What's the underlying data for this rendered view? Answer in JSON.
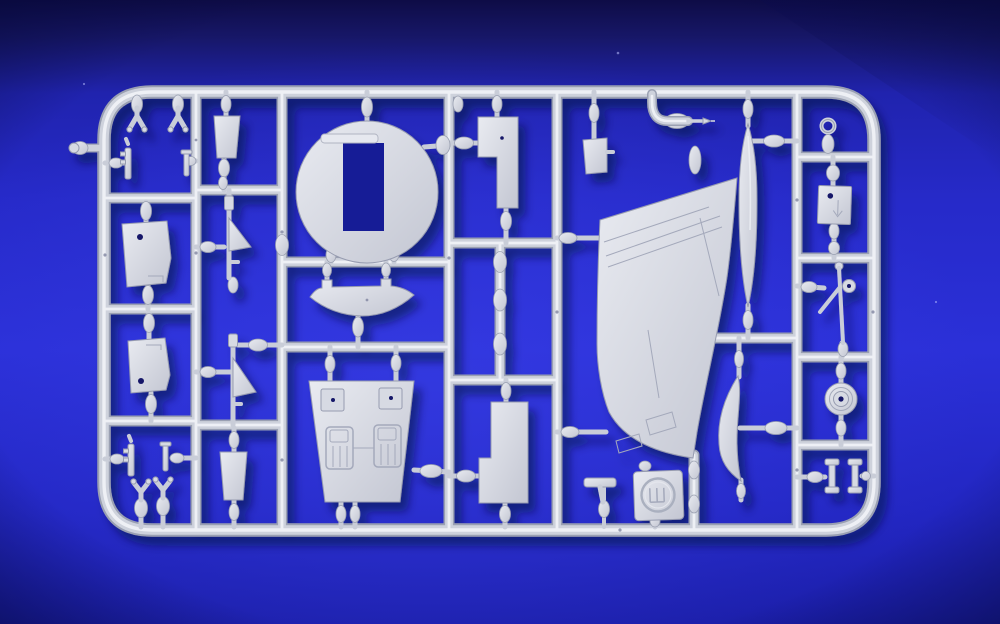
{
  "scene": {
    "type": "photograph",
    "description": "Photograph of an injection-moulded plastic model aircraft kit sprue (runner frame with parts) in light grey styrene, lying on a royal blue fabric background. No readable text appears in the image; one small square part carries a circular maker's emblem.",
    "text_visible": false
  },
  "colors": {
    "bg-deep": "#0e0c46",
    "bg-mid": "#262ac9",
    "bg-bright": "#2e33da",
    "runner-dark": "#9aa0b2",
    "runner-mid": "#ced2dc",
    "runner-light": "#eef0f5",
    "plastic-edge": "#979cb0",
    "engrave": "#a4a9bb",
    "hole": "#141768",
    "shadow": "#060a3e"
  },
  "sprue": {
    "material": "light grey styrene plastic",
    "frame_shape": "rounded rectangle runner frame with internal cross-runners",
    "parts": [
      {
        "id": "vertical-tail-fin",
        "qty": 1,
        "note": "large swept fin with engraved panel lines"
      },
      {
        "id": "tail-bullet-fairing",
        "qty": 1,
        "note": "long slender teardrop beside fin"
      },
      {
        "id": "bulkhead-disc-with-slot",
        "qty": 1,
        "note": "large disc with rectangular cutout and thin slot bar"
      },
      {
        "id": "cockpit-tub-with-seats",
        "qty": 1,
        "note": "trapezoid tub, two headrests, two engraved seats"
      },
      {
        "id": "lower-cowl-boat-part",
        "qty": 1
      },
      {
        "id": "gear-door-trapezoid",
        "qty": 2,
        "note": "each with one small locating hole"
      },
      {
        "id": "stepped-fuselage-insert",
        "qty": 2
      },
      {
        "id": "intake-trapezoid-small",
        "qty": 3
      },
      {
        "id": "landing-gear-leg-a-frame",
        "qty": 2
      },
      {
        "id": "mini-strut-gun-part",
        "qty": 4
      },
      {
        "id": "y-fork-part",
        "qty": 4
      },
      {
        "id": "pitot-probe-on-curved-runner",
        "qty": 1
      },
      {
        "id": "crescent-intake-lip",
        "qty": 1
      },
      {
        "id": "maker-logo-plate",
        "qty": 1,
        "note": "square plate, embossed circular emblem with trident-like glyph"
      },
      {
        "id": "arrow-marked-plate",
        "qty": 1,
        "note": "small plate with hole and engraved down arrow"
      },
      {
        "id": "eyelet-ring-part",
        "qty": 1
      },
      {
        "id": "main-wheel",
        "qty": 1,
        "note": "disc wheel with hub hole"
      },
      {
        "id": "small-hub-strut-assembly",
        "qty": 1
      },
      {
        "id": "i-beam-brace",
        "qty": 2
      },
      {
        "id": "t-shaped-pylon",
        "qty": 1
      },
      {
        "id": "external-sprue-tab",
        "qty": 1,
        "note": "stub protruding from left outer rail"
      }
    ]
  },
  "logo": {
    "style": "embossed circle emblem",
    "glyph": "three vertical strokes on a base (trident / Ш-like mark)",
    "readable_text": ""
  }
}
